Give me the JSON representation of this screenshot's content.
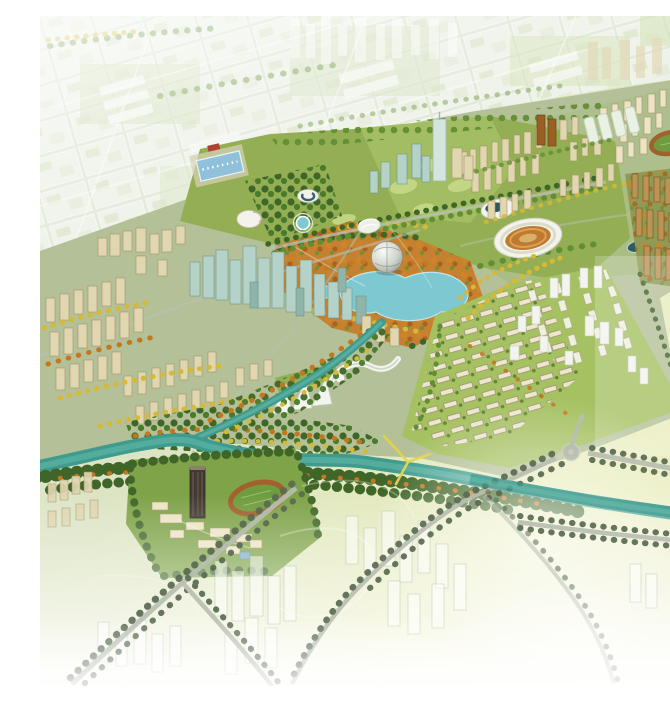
{
  "scene": {
    "description": "Bird's-eye architectural rendering of a planned riverside city: hazy grid district to the northwest, a central landscaped park with fountain plaza, egg-shaped hall, geodesic sphere pavilion, lake with autumn foliage, white oval stadium and arena, glass CBD towers, beige residential quarters, a grid of golden high-rises to the east, low-rise estates, a teal river with tree-lined banks and a yellow footbridge, a campus with a running track, and tree-lined roads fading into white haze toward the south-east fields.",
    "view": "aerial bird's-eye",
    "setting": "daytime, hazy"
  },
  "palette": {
    "skyTop": "#e9eee1",
    "skyMid": "#dfe7c9",
    "fieldPale": "#e9edbb",
    "fadedBase": "#dde5d2",
    "parkGreen": "#93ae53",
    "parkGreen2": "#a3bd62",
    "lawnLight": "#c8da8c",
    "treeDark": "#3f6628",
    "treeMid": "#628f33",
    "treeYellow": "#d6b937",
    "treeOrange": "#c4771f",
    "autumnGround": "#c58030",
    "river": "#3f9b8e",
    "riverLight": "#6fc0ae",
    "lake": "#7ec8d2",
    "road": "#b9bfb2",
    "roadTree": "#5a6b52",
    "beige": "#e0d6b0",
    "beigeLight": "#ecE4c4",
    "beigeEdge": "#a3946c",
    "glass": "#b5d2c8",
    "glassDark": "#8fb5ab",
    "glassEdge": "#6f958b",
    "white": "#f3f4ee",
    "whiteEdge": "#c2c8ba",
    "gold": "#bb9355",
    "goldEdge": "#7a5c2c",
    "stadiumField": "#c07a2e",
    "trackBrown": "#a2602c",
    "fieldGreen": "#6f9c3f",
    "campusDark": "#423b32",
    "fountainBlue": "#8fc2da",
    "orangeTower": "#9a5f24",
    "bridgeYellow": "#e6d24a"
  },
  "landmarks": [
    "fountain-plaza",
    "egg-dome-hall",
    "courtyard-disc-building",
    "shell-pavilion",
    "geodesic-sphere-pavilion",
    "central-lake",
    "autumn-park",
    "grand-stadium",
    "indoor-arena",
    "dark-lens-hall",
    "landmark-glass-tower",
    "cbd-glass-towers",
    "riverside-residential-rows",
    "northeast-residential-district",
    "greenhouse-rows",
    "athletics-track-northeast",
    "golden-tower-district",
    "low-rise-estate",
    "sail-buildings",
    "swan-cultural-center",
    "teal-river",
    "yellow-footbridge",
    "campus-tower",
    "campus-running-track",
    "roundabout-interchange",
    "tree-lined-roads",
    "ghost-towers-in-haze",
    "southeast-fields"
  ]
}
